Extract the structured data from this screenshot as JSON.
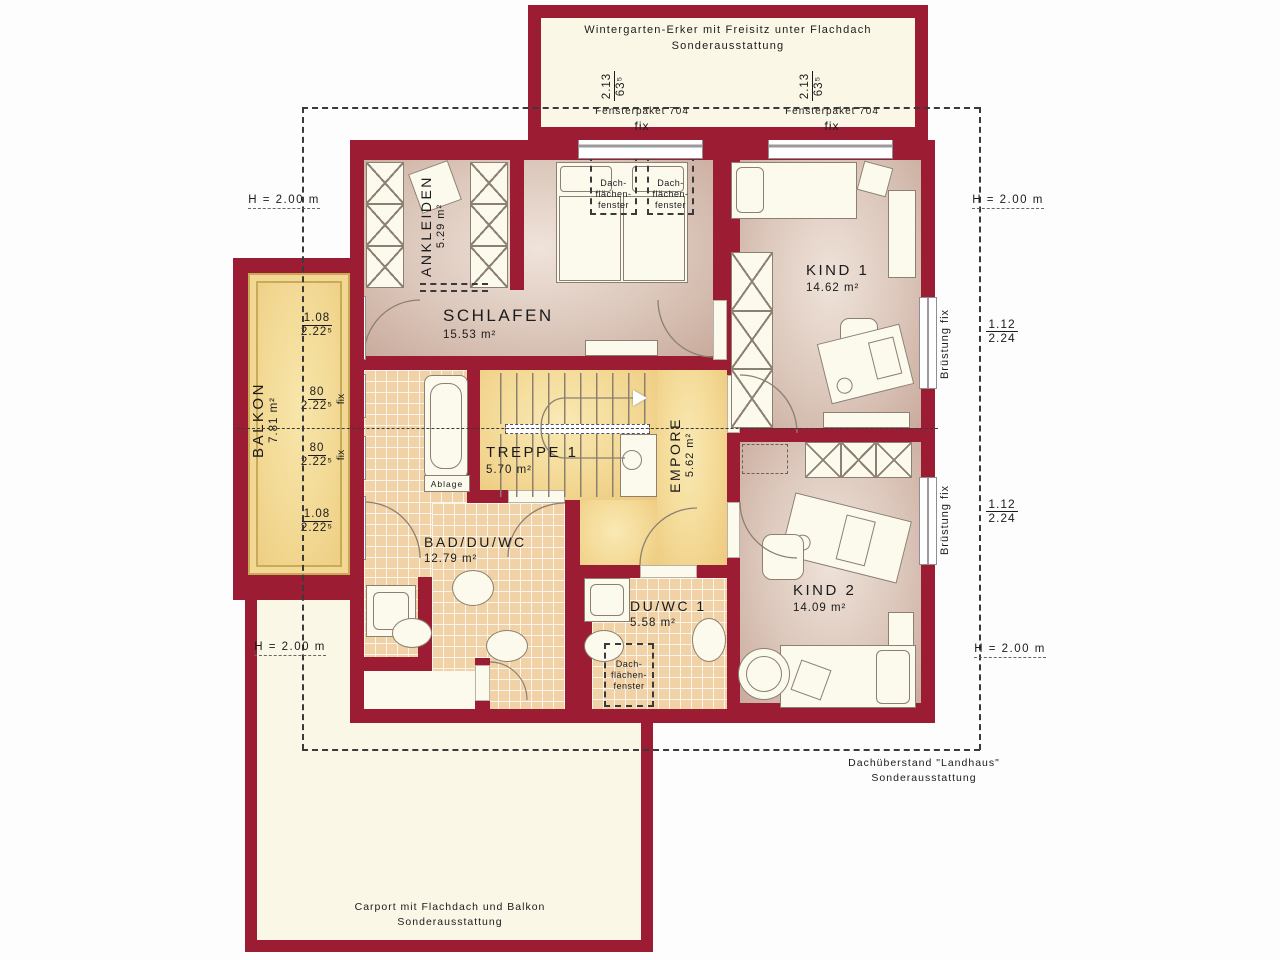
{
  "colors": {
    "wall": "#9c1c33",
    "room_floor": "#dcc7bb",
    "tile_floor": "#f1d2a6",
    "wood_floor": "#f4da97",
    "outdoor": "#faf7e7",
    "dash": "#3a3a3a"
  },
  "wintergarten": {
    "title": "Wintergarten-Erker mit Freisitz unter Flachdach",
    "subtitle": "Sonderausstattung",
    "windows": [
      {
        "dim": "2.13",
        "dim2": "63⁵",
        "pkg": "Fensterpaket 704",
        "fix": "fix"
      },
      {
        "dim": "2.13",
        "dim2": "63⁵",
        "pkg": "Fensterpaket 704",
        "fix": "fix"
      }
    ]
  },
  "rooms": {
    "ankleiden": {
      "name": "ANKLEIDEN",
      "area": "5.29 m²"
    },
    "schlafen": {
      "name": "SCHLAFEN",
      "area": "15.53 m²"
    },
    "kind1": {
      "name": "KIND 1",
      "area": "14.62 m²"
    },
    "balkon": {
      "name": "BALKON",
      "area": "7.81 m²"
    },
    "treppe": {
      "name": "TREPPE 1",
      "area": "5.70 m²"
    },
    "empore": {
      "name": "EMPORE",
      "area": "5.62 m²"
    },
    "bad": {
      "name": "BAD/DU/WC",
      "area": "12.79 m²"
    },
    "duwc": {
      "name": "DU/WC 1",
      "area": "5.58 m²"
    },
    "kind2": {
      "name": "KIND 2",
      "area": "14.09 m²"
    }
  },
  "balkon_dims": [
    {
      "top": "1.08",
      "bot": "2.22⁵"
    },
    {
      "top": "80",
      "bot": "2.22⁵",
      "fix": "fix"
    },
    {
      "top": "80",
      "bot": "2.22⁵",
      "fix": "fix"
    },
    {
      "top": "1.08",
      "bot": "2.22⁵"
    }
  ],
  "height_marks": [
    "H = 2.00 m",
    "H = 2.00 m",
    "H = 2.00 m",
    "H = 2.00 m"
  ],
  "right_dims": [
    {
      "top": "1.12",
      "bot": "2.24",
      "rail": "Brüstung fix"
    },
    {
      "top": "1.12",
      "bot": "2.24",
      "rail": "Brüstung fix"
    }
  ],
  "roof_window_label": [
    "Dach-",
    "flächen-",
    "fenster"
  ],
  "ablage": "Ablage",
  "notes": {
    "dachueberstand": [
      "Dachüberstand \"Landhaus\"",
      "Sonderausstattung"
    ],
    "carport": [
      "Carport mit Flachdach und Balkon",
      "Sonderausstattung"
    ]
  }
}
